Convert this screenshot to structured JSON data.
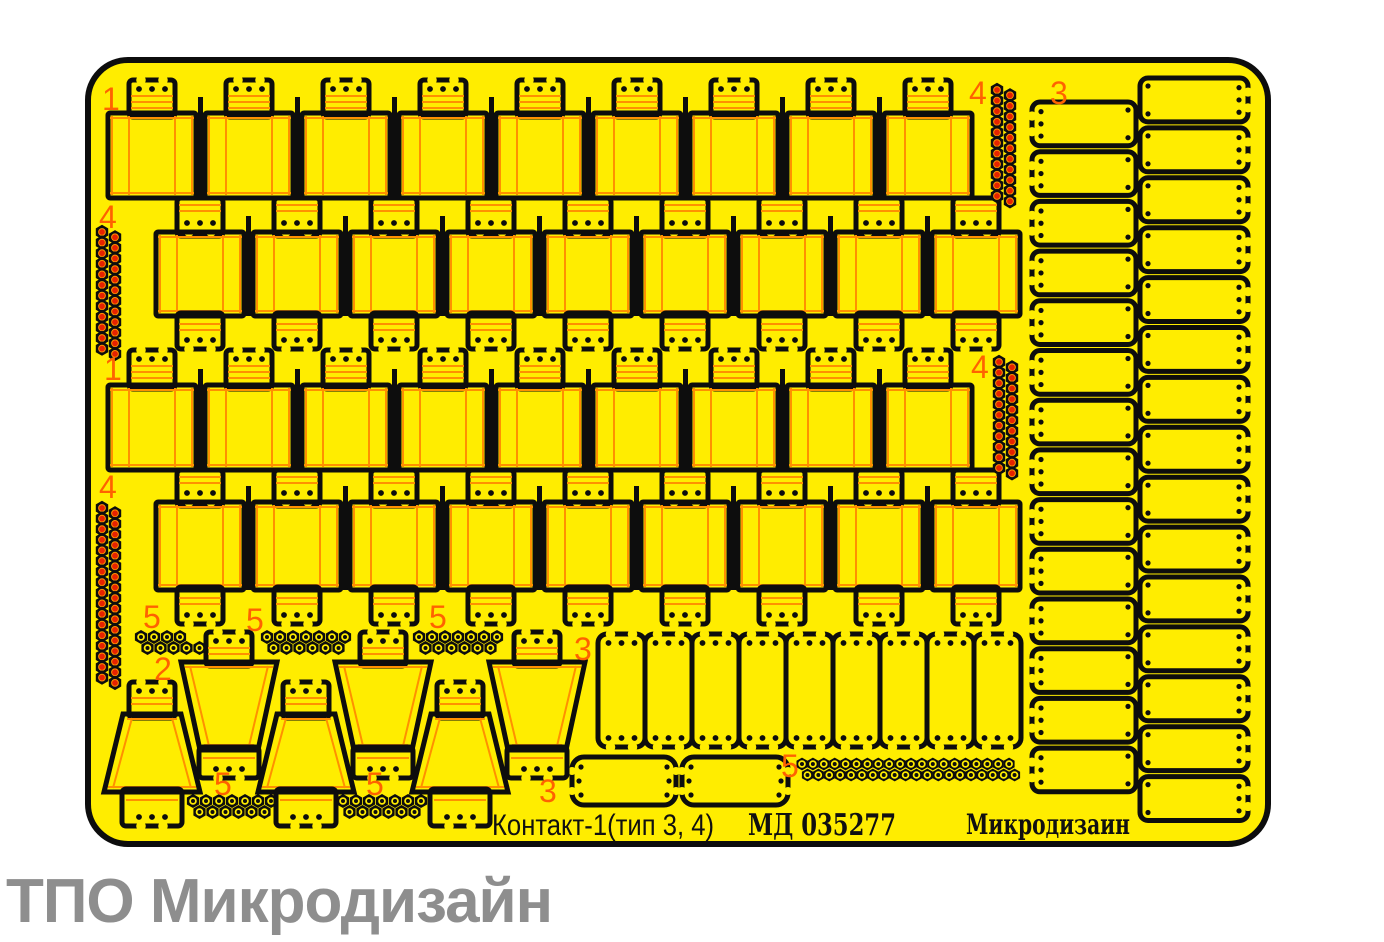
{
  "page": {
    "background": "#ffffff"
  },
  "colors": {
    "sheet": "#ffed00",
    "outline": "#0d0d0d",
    "fold": "#ff9000",
    "label": "#ff6200",
    "bolt_red": "#e62200",
    "footer_gray": "#8e8e8e",
    "text_black": "#101010"
  },
  "sheet": {
    "x": 88,
    "y": 60,
    "width": 1180,
    "height": 784,
    "radius": 40
  },
  "captions": {
    "product": "Контакт-1(тип 3, 4)",
    "code": "МД 035277",
    "brand": "Микродизаин",
    "footer": "ТПО Микродизайн"
  },
  "caption_pos": {
    "product": {
      "x": 492,
      "y": 835,
      "len": 222
    },
    "code": {
      "x": 748,
      "y": 835,
      "len": 148
    },
    "brand": {
      "x": 966,
      "y": 834,
      "len": 164
    }
  },
  "labels": [
    {
      "text": "1",
      "x": 102,
      "y": 110
    },
    {
      "text": "4",
      "x": 99,
      "y": 228
    },
    {
      "text": "1",
      "x": 104,
      "y": 380
    },
    {
      "text": "4",
      "x": 99,
      "y": 498
    },
    {
      "text": "4",
      "x": 969,
      "y": 104
    },
    {
      "text": "3",
      "x": 1050,
      "y": 104
    },
    {
      "text": "4",
      "x": 971,
      "y": 378
    },
    {
      "text": "5",
      "x": 143,
      "y": 628
    },
    {
      "text": "5",
      "x": 246,
      "y": 631
    },
    {
      "text": "5",
      "x": 429,
      "y": 628
    },
    {
      "text": "2",
      "x": 154,
      "y": 680
    },
    {
      "text": "3",
      "x": 574,
      "y": 660
    },
    {
      "text": "5",
      "x": 214,
      "y": 795
    },
    {
      "text": "5",
      "x": 366,
      "y": 795
    },
    {
      "text": "3",
      "x": 539,
      "y": 802
    },
    {
      "text": "5",
      "x": 781,
      "y": 777
    }
  ],
  "block_rows": [
    {
      "count": 9,
      "first_cx": 152,
      "pitch": 97,
      "tab_y": 80,
      "tab_h": 33,
      "body_y": 113,
      "body_h": 85,
      "crown": "up"
    },
    {
      "count": 9,
      "first_cx": 200,
      "pitch": 97,
      "tab_y": 198,
      "tab_h": 34,
      "body_y": 232,
      "body_h": 84,
      "bottom_tab_h": 33,
      "crown": "down"
    },
    {
      "count": 9,
      "first_cx": 152,
      "pitch": 97,
      "tab_y": 350,
      "tab_h": 35,
      "body_y": 385,
      "body_h": 85,
      "crown": "up"
    },
    {
      "count": 9,
      "first_cx": 200,
      "pitch": 97,
      "tab_y": 470,
      "tab_h": 32,
      "body_y": 502,
      "body_h": 88,
      "bottom_tab_h": 34,
      "crown": "down"
    }
  ],
  "ladder_columns": [
    {
      "x": 1032,
      "width": 104,
      "top": 102,
      "rungs": 14,
      "pitch": 49.7,
      "scallop_side": "left"
    },
    {
      "x": 1140,
      "width": 108,
      "top": 78,
      "rungs": 15,
      "pitch": 49.9,
      "scallop_side": "right"
    }
  ],
  "bolt_strips_vertical": [
    {
      "x": 102,
      "y": 232,
      "nuts_per_col": 12,
      "spacing": 10.6
    },
    {
      "x": 997,
      "y": 90,
      "nuts_per_col": 11,
      "spacing": 10.6
    },
    {
      "x": 999,
      "y": 362,
      "nuts_per_col": 11,
      "spacing": 10.6
    },
    {
      "x": 102,
      "y": 508,
      "nuts_per_col": 17,
      "spacing": 10.6
    }
  ],
  "bolt_clusters": [
    {
      "x": 141,
      "y": 637,
      "top": 4,
      "bottom": 5
    },
    {
      "x": 267,
      "y": 637,
      "top": 7,
      "bottom": 6
    },
    {
      "x": 419,
      "y": 637,
      "top": 7,
      "bottom": 6
    },
    {
      "x": 193,
      "y": 801,
      "top": 7,
      "bottom": 6
    },
    {
      "x": 343,
      "y": 801,
      "top": 7,
      "bottom": 6
    }
  ],
  "bolt_strip_horizontal": {
    "x": 802,
    "y": 764,
    "count": 20,
    "spacing": 10.9,
    "row_gap": 11
  },
  "panel_group": {
    "x": 598,
    "y": 634,
    "count": 9,
    "panel_w": 47,
    "panel_h": 113
  },
  "cover_plates": [
    {
      "x": 572,
      "y": 757,
      "w": 104,
      "h": 48
    },
    {
      "x": 682,
      "y": 757,
      "w": 106,
      "h": 48
    }
  ],
  "wedge_blocks": [
    {
      "cx": 152,
      "type": "wide_bottom"
    },
    {
      "cx": 229,
      "type": "wide_top"
    },
    {
      "cx": 306,
      "type": "wide_bottom"
    },
    {
      "cx": 383,
      "type": "wide_top"
    },
    {
      "cx": 460,
      "type": "wide_bottom"
    },
    {
      "cx": 537,
      "type": "wide_top"
    }
  ],
  "wedge_geom": {
    "wide_bottom": {
      "tab_y": 682,
      "tab_h": 32,
      "body_top": 714,
      "body_bot": 792,
      "top_w": 58,
      "bot_w": 96,
      "flap_h": 34
    },
    "wide_top": {
      "tab_y": 632,
      "tab_h": 30,
      "body_top": 662,
      "body_bot": 750,
      "top_w": 96,
      "bot_w": 58,
      "flap_h": 28
    }
  },
  "footer_pos": {
    "x": 6,
    "y": 866
  }
}
